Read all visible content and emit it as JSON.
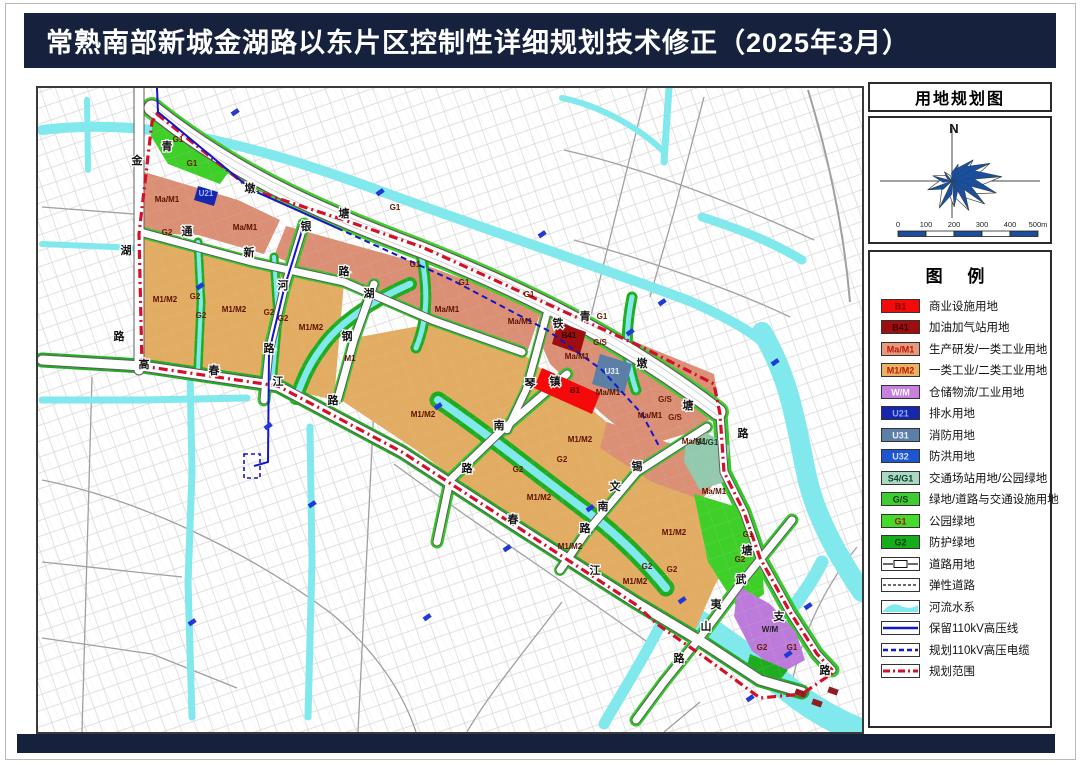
{
  "header": {
    "title": "常熟南部新城金湖路以东片区控制性详细规划技术修正（2025年3月）"
  },
  "sidebar": {
    "map_title": "用地规划图",
    "compass_label": "N",
    "scale_ticks": [
      "0",
      "100",
      "200",
      "300",
      "400",
      "500m"
    ],
    "legend_title": "图  例"
  },
  "legend": {
    "items": [
      {
        "code": "B1",
        "label": "商业设施用地",
        "type": "fill",
        "color": "#F40A0A",
        "text_color": "#7a0000"
      },
      {
        "code": "B41",
        "label": "加油加气站用地",
        "type": "fill",
        "color": "#9E0E0E",
        "text_color": "#400000"
      },
      {
        "code": "Ma/M1",
        "label": "生产研发/一类工业用地",
        "type": "fill",
        "color": "#E59A7F",
        "text_color": "#c01800"
      },
      {
        "code": "M1/M2",
        "label": "一类工业/二类工业用地",
        "type": "fill",
        "color": "#E9B266",
        "text_color": "#c01800"
      },
      {
        "code": "W/M",
        "label": "仓储物流/工业用地",
        "type": "fill",
        "color": "#C87FE0",
        "text_color": "#ffffff"
      },
      {
        "code": "U21",
        "label": "排水用地",
        "type": "fill",
        "color": "#1627AE",
        "text_color": "#8fa6ff"
      },
      {
        "code": "U31",
        "label": "消防用地",
        "type": "fill",
        "color": "#5C7FA8",
        "text_color": "#e8f1fa"
      },
      {
        "code": "U32",
        "label": "防洪用地",
        "type": "fill",
        "color": "#1F55CE",
        "text_color": "#cfe0ff"
      },
      {
        "code": "S4/G1",
        "label": "交通场站用地/公园绿地",
        "type": "fill",
        "color": "#A9D8C2",
        "text_color": "#133f2a"
      },
      {
        "code": "G/S",
        "label": "绿地/道路与交通设施用地",
        "type": "fill",
        "color": "#3FCC33",
        "text_color": "#0c3d0c"
      },
      {
        "code": "G1",
        "label": "公园绿地",
        "type": "fill",
        "color": "#44DB2B",
        "text_color": "#a81400"
      },
      {
        "code": "G2",
        "label": "防护绿地",
        "type": "fill",
        "color": "#15AD1C",
        "text_color": "#073f07"
      },
      {
        "code": "",
        "label": "道路用地",
        "type": "road"
      },
      {
        "code": "",
        "label": "弹性道路",
        "type": "dash"
      },
      {
        "code": "",
        "label": "河流水系",
        "type": "water",
        "color": "#7FE9ED"
      },
      {
        "code": "",
        "label": "保留110kV高压线",
        "type": "hv-solid",
        "color": "#1515CC"
      },
      {
        "code": "",
        "label": "规划110kV高压电缆",
        "type": "hv-dash",
        "color": "#1515CC"
      },
      {
        "code": "",
        "label": "规划范围",
        "type": "boundary",
        "color": "#D40F28"
      }
    ]
  },
  "map": {
    "zone_labels": [
      {
        "t": "Ma/M1",
        "x": 165,
        "y": 200,
        "k": "warm"
      },
      {
        "t": "Ma/M1",
        "x": 243,
        "y": 228,
        "k": "warm"
      },
      {
        "t": "Ma/M1",
        "x": 445,
        "y": 310,
        "k": "warm"
      },
      {
        "t": "Ma/M1",
        "x": 518,
        "y": 322,
        "k": "warm"
      },
      {
        "t": "Ma/M1",
        "x": 575,
        "y": 357,
        "k": "warm"
      },
      {
        "t": "Ma/M1",
        "x": 606,
        "y": 393,
        "k": "warm"
      },
      {
        "t": "Ma/M1",
        "x": 648,
        "y": 416,
        "k": "warm"
      },
      {
        "t": "Ma/M1",
        "x": 692,
        "y": 442,
        "k": "warm"
      },
      {
        "t": "Ma/M1",
        "x": 712,
        "y": 492,
        "k": "warm"
      },
      {
        "t": "M1/M2",
        "x": 163,
        "y": 300,
        "k": "warm"
      },
      {
        "t": "M1/M2",
        "x": 232,
        "y": 310,
        "k": "warm"
      },
      {
        "t": "M1/M2",
        "x": 309,
        "y": 328,
        "k": "warm"
      },
      {
        "t": "M1/M2",
        "x": 421,
        "y": 415,
        "k": "warm"
      },
      {
        "t": "M1/M2",
        "x": 578,
        "y": 440,
        "k": "warm"
      },
      {
        "t": "M1/M2",
        "x": 537,
        "y": 498,
        "k": "warm"
      },
      {
        "t": "M1/M2",
        "x": 568,
        "y": 547,
        "k": "warm"
      },
      {
        "t": "M1/M2",
        "x": 633,
        "y": 582,
        "k": "warm"
      },
      {
        "t": "M1/M2",
        "x": 672,
        "y": 533,
        "k": "warm"
      },
      {
        "t": "M1",
        "x": 348,
        "y": 359,
        "k": "warm"
      },
      {
        "t": "G1",
        "x": 176,
        "y": 140,
        "k": "green"
      },
      {
        "t": "G1",
        "x": 190,
        "y": 164,
        "k": "green"
      },
      {
        "t": "G1",
        "x": 393,
        "y": 208,
        "k": "green"
      },
      {
        "t": "G1",
        "x": 413,
        "y": 265,
        "k": "green"
      },
      {
        "t": "G1",
        "x": 462,
        "y": 283,
        "k": "green"
      },
      {
        "t": "G1",
        "x": 527,
        "y": 295,
        "k": "green"
      },
      {
        "t": "G1",
        "x": 600,
        "y": 317,
        "k": "green"
      },
      {
        "t": "G1",
        "x": 746,
        "y": 535,
        "k": "green"
      },
      {
        "t": "G1",
        "x": 790,
        "y": 648,
        "k": "green"
      },
      {
        "t": "G2",
        "x": 165,
        "y": 233,
        "k": "green"
      },
      {
        "t": "G2",
        "x": 193,
        "y": 297,
        "k": "green"
      },
      {
        "t": "G2",
        "x": 199,
        "y": 316,
        "k": "green"
      },
      {
        "t": "G2",
        "x": 267,
        "y": 313,
        "k": "green"
      },
      {
        "t": "G2",
        "x": 281,
        "y": 319,
        "k": "green"
      },
      {
        "t": "G2",
        "x": 560,
        "y": 460,
        "k": "green"
      },
      {
        "t": "G2",
        "x": 516,
        "y": 470,
        "k": "green"
      },
      {
        "t": "G2",
        "x": 645,
        "y": 567,
        "k": "green"
      },
      {
        "t": "G2",
        "x": 670,
        "y": 570,
        "k": "green"
      },
      {
        "t": "G2",
        "x": 738,
        "y": 560,
        "k": "green"
      },
      {
        "t": "G2",
        "x": 760,
        "y": 648,
        "k": "green"
      },
      {
        "t": "G/S",
        "x": 598,
        "y": 343,
        "k": "green"
      },
      {
        "t": "G/S",
        "x": 663,
        "y": 400,
        "k": "green"
      },
      {
        "t": "G/S",
        "x": 673,
        "y": 418,
        "k": "green"
      },
      {
        "t": "S4/G1",
        "x": 705,
        "y": 443,
        "k": "teal"
      },
      {
        "t": "B1",
        "x": 573,
        "y": 391,
        "k": "b1"
      },
      {
        "t": "B41",
        "x": 567,
        "y": 336,
        "k": "b41"
      },
      {
        "t": "U31",
        "x": 610,
        "y": 372,
        "k": "u31"
      },
      {
        "t": "U21",
        "x": 204,
        "y": 194,
        "k": "u21"
      },
      {
        "t": "W/M",
        "x": 768,
        "y": 630,
        "k": "wm"
      }
    ],
    "road_labels": [
      {
        "t": "金",
        "x": 135,
        "y": 162
      },
      {
        "t": "湖",
        "x": 124,
        "y": 252
      },
      {
        "t": "路",
        "x": 117,
        "y": 338
      },
      {
        "t": "青",
        "x": 165,
        "y": 148
      },
      {
        "t": "墩",
        "x": 248,
        "y": 190
      },
      {
        "t": "塘",
        "x": 342,
        "y": 215
      },
      {
        "t": "通",
        "x": 185,
        "y": 233
      },
      {
        "t": "新",
        "x": 247,
        "y": 254
      },
      {
        "t": "路",
        "x": 342,
        "y": 273
      },
      {
        "t": "银",
        "x": 304,
        "y": 228
      },
      {
        "t": "河",
        "x": 281,
        "y": 287
      },
      {
        "t": "路",
        "x": 267,
        "y": 350
      },
      {
        "t": "湖",
        "x": 367,
        "y": 295
      },
      {
        "t": "钢",
        "x": 345,
        "y": 338
      },
      {
        "t": "青",
        "x": 583,
        "y": 318
      },
      {
        "t": "墩",
        "x": 640,
        "y": 365
      },
      {
        "t": "塘",
        "x": 686,
        "y": 407
      },
      {
        "t": "路",
        "x": 741,
        "y": 435
      },
      {
        "t": "铁",
        "x": 556,
        "y": 325
      },
      {
        "t": "琴",
        "x": 528,
        "y": 385
      },
      {
        "t": "镇",
        "x": 553,
        "y": 383
      },
      {
        "t": "南",
        "x": 497,
        "y": 427
      },
      {
        "t": "路",
        "x": 465,
        "y": 470
      },
      {
        "t": "锡",
        "x": 635,
        "y": 468
      },
      {
        "t": "文",
        "x": 613,
        "y": 488
      },
      {
        "t": "南",
        "x": 601,
        "y": 508
      },
      {
        "t": "路",
        "x": 583,
        "y": 530
      },
      {
        "t": "高",
        "x": 142,
        "y": 366
      },
      {
        "t": "春",
        "x": 212,
        "y": 372
      },
      {
        "t": "江",
        "x": 276,
        "y": 383
      },
      {
        "t": "路",
        "x": 331,
        "y": 402
      },
      {
        "t": "春",
        "x": 511,
        "y": 521
      },
      {
        "t": "江",
        "x": 593,
        "y": 572
      },
      {
        "t": "武",
        "x": 739,
        "y": 581
      },
      {
        "t": "夷",
        "x": 714,
        "y": 606
      },
      {
        "t": "山",
        "x": 704,
        "y": 628
      },
      {
        "t": "路",
        "x": 677,
        "y": 660
      },
      {
        "t": "支",
        "x": 777,
        "y": 618
      },
      {
        "t": "路",
        "x": 823,
        "y": 672
      },
      {
        "t": "塘",
        "x": 745,
        "y": 552
      }
    ]
  }
}
